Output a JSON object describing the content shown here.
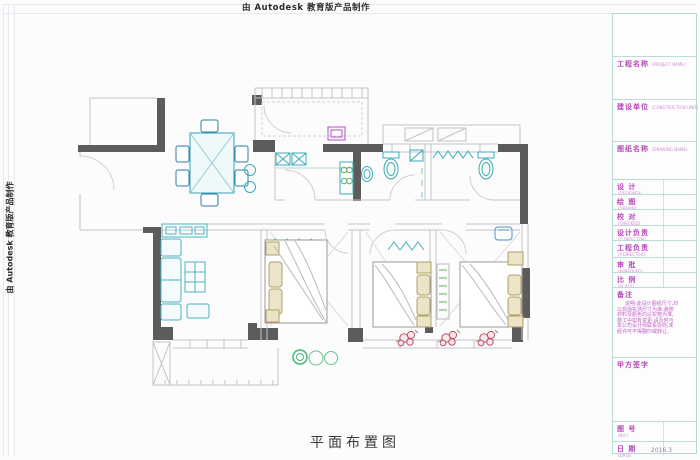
{
  "banner": {
    "text": "由 Autodesk 教育版产品制作"
  },
  "drawing": {
    "title": "平面布置图"
  },
  "colors": {
    "wall": "#5c5c5c",
    "furniture_cyan": "#3aacb8",
    "label_magenta": "#b648b8",
    "block_border_teal": "#bcdad6",
    "flower_red": "#c4506a",
    "plant_green": "#46b878"
  },
  "titleblock": {
    "project_name": {
      "label": "工程名称",
      "sub": "(PROJECT NAME)"
    },
    "construction_unit": {
      "label": "建设单位",
      "sub": "(CONSTRUCTION UNIT)"
    },
    "drawing_name": {
      "label": "图纸名称",
      "sub": "(DRAWING NAME)"
    },
    "rows": [
      {
        "label": "设  计",
        "sub": "(DESIGNER)"
      },
      {
        "label": "绘  图",
        "sub": "(DRAWN)"
      },
      {
        "label": "校  对",
        "sub": "(CHECKED)"
      },
      {
        "label": "设计负责",
        "sub": "(D.DIRECTOR)"
      },
      {
        "label": "工程负责",
        "sub": "(P.DIRECTOR)"
      },
      {
        "label": "审  批",
        "sub": "(APPROVED)"
      },
      {
        "label": "比  例",
        "sub": "(SCALE)"
      }
    ],
    "remark": {
      "label": "备注",
      "lines": [
        "说明:此设计图纸尺寸,均",
        "以现场实测尺寸为准,装修",
        "材料及颜色均以实物为准,",
        "施工中如有变更,请及时与",
        "本公司设计师联系协商,未",
        "经许可不得翻印或转让。"
      ]
    },
    "client_sign": {
      "label": "甲方签字"
    },
    "drawing_no": {
      "label": "图  号",
      "sub": "(NO.)"
    },
    "date": {
      "label": "日  期",
      "sub": "(DATE)",
      "value": "2016.3"
    }
  }
}
